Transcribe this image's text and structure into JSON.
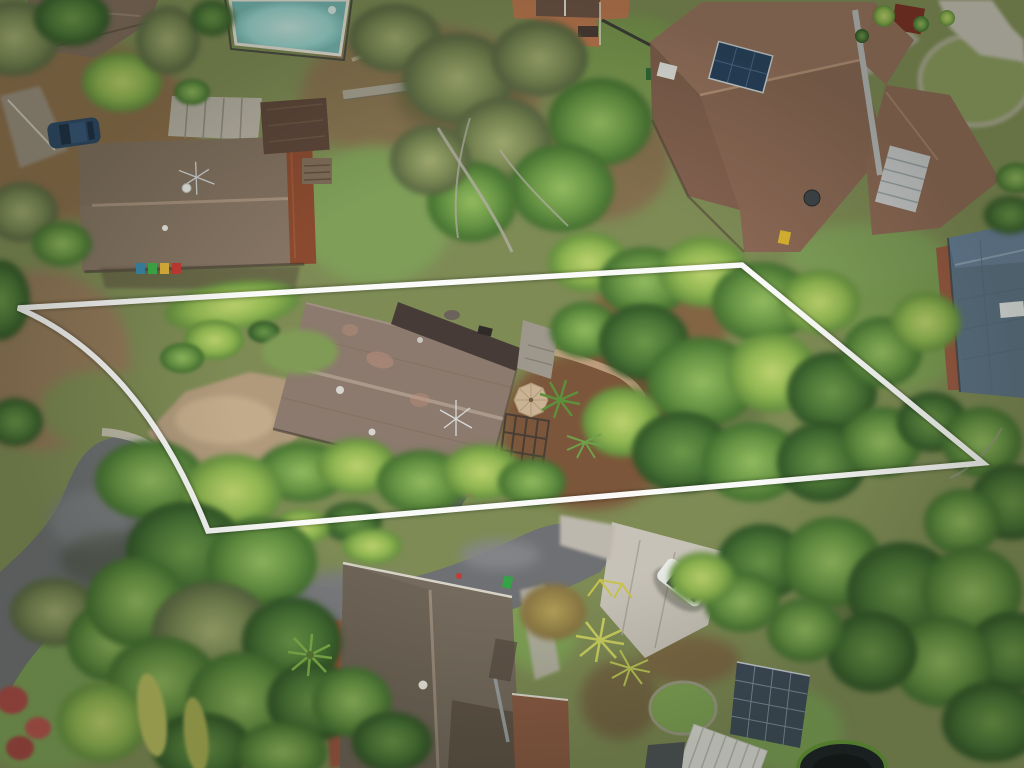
{
  "image": {
    "type": "aerial-drone-photograph",
    "subject": "suburban residential lot outlined with a white property boundary",
    "width": 1024,
    "height": 768
  },
  "boundary": {
    "color": "#ffffff",
    "stroke_width": 5.5,
    "path_d": "M 18,308 L 742,265 L 983,463 L 208,531 Q 140,360 18,308 Z",
    "shape": "quadrilateral lot outline with curved street frontage on the left"
  },
  "palette": {
    "ground_base": "#7e8b55",
    "canopy_bright": "#9dc45f",
    "canopy_mid": "#6f9a45",
    "canopy_dark": "#4d7737",
    "canopy_olive": "#8c9a64",
    "lawn": "#7f9e58",
    "dirt": "#96755a",
    "mulch": "#7b5138",
    "asphalt": "#6e7073",
    "concrete": "#c7c2b7",
    "gravel_drive": "#b19a7b",
    "brick_path": "#9c5743",
    "subject_roof": "#8b7a6d",
    "subject_roof_ridge": "#ab9a8b",
    "flat_deck_roof": "#473b37",
    "neighbor_roof_left": "#81705f",
    "neighbor_roof_right": "#8a6754",
    "neighbor_roof_bottom": "#756a5e",
    "roof_blue": "#5d7386",
    "rust_roof": "#8a4a30",
    "pool_water": "#9ad6d2",
    "solar_panel": "#27415f",
    "umbrella": "#c9b394",
    "car_blue": "#2c4766",
    "car_white": "#e9ebe8",
    "van_canopy": "#d3d6d5",
    "van_cab": "#3c4044",
    "trampoline_mat": "#1c2126",
    "trampoline_rim": "#649638",
    "white_metal_roof": "#dfe0da",
    "solar_pergola": "#39465a",
    "orange_house_wall": "#bf7850"
  },
  "objects": {
    "pool": {
      "label": "backyard swimming pool",
      "position": "top left"
    },
    "subject_house": {
      "label": "brown tiled gable roof house inside boundary",
      "features": [
        "tv-antenna",
        "flat roof deck",
        "patio umbrella",
        "pergola frame"
      ]
    },
    "neighbor_houses": [
      {
        "label": "grey-brown tiled house with rust section",
        "position": "upper left",
        "features": [
          "wheelie bins teal/green/yellow/red",
          "tv-antenna",
          "satellite dish"
        ]
      },
      {
        "label": "large terracotta hip-roof house",
        "position": "upper right",
        "features": [
          "solar panels",
          "glass atrium",
          "satellite dish"
        ]
      },
      {
        "label": "steel-blue tiled house",
        "position": "right edge",
        "features": [
          "white skylight"
        ]
      },
      {
        "label": "grey tiled house",
        "position": "bottom centre",
        "features": [
          "white chimney",
          "brick path"
        ]
      }
    ],
    "vehicles": [
      {
        "label": "dark blue hatchback",
        "position": "parked beside upper-left house"
      },
      {
        "label": "white SUV",
        "position": "concrete pad lower right"
      },
      {
        "label": "dark ute with white canopy",
        "position": "driveway below cul-de-sac"
      }
    ],
    "road": {
      "label": "cul-de-sac with asphalt street",
      "position": "bottom left"
    },
    "garden": {
      "label": "dense tree canopy, trimmed hedges, palms, trampoline, solar pergola, conifer spires, red flowering shrubs"
    }
  }
}
